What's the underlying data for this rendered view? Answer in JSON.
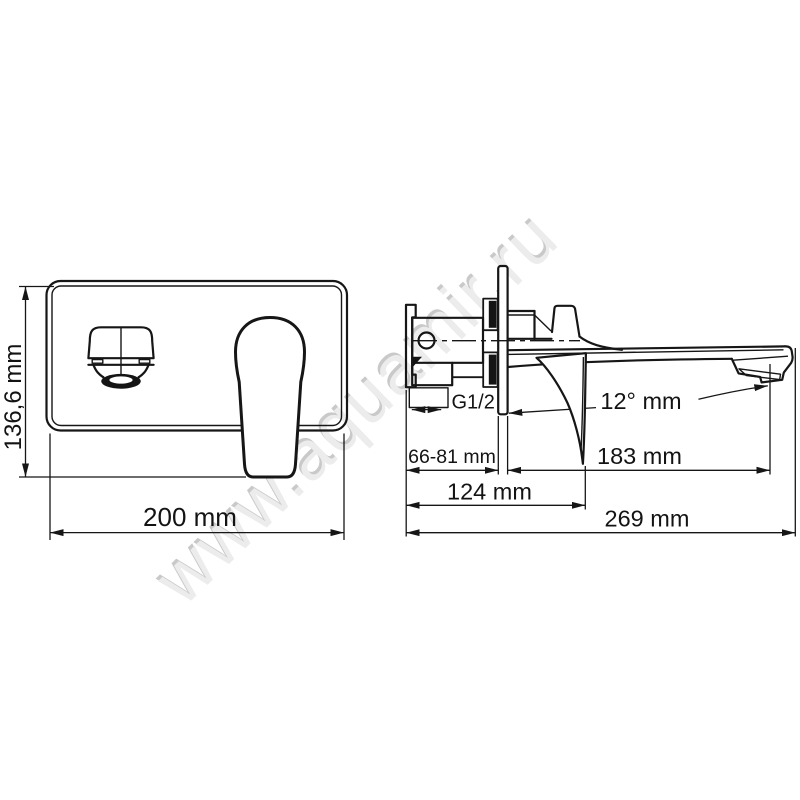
{
  "page": {
    "title": "Wall-mounted basin mixer dimensional drawing",
    "background_color": "#ffffff",
    "line_color": "#161616",
    "watermark_color": "#e0e0e0"
  },
  "watermark": {
    "text": "www.aquamir.ru"
  },
  "front_view": {
    "name": "faucet-front-view",
    "dim_height_label": "136,6 mm",
    "dim_width_label": "200 mm"
  },
  "side_view": {
    "name": "faucet-side-view",
    "thread_label": "G1/2",
    "angle_label": "12° mm",
    "dim_depth_label": "66-81 mm",
    "dim_spout_label": "183 mm",
    "dim_handle_label": "124 mm",
    "dim_total_label": "269 mm"
  }
}
